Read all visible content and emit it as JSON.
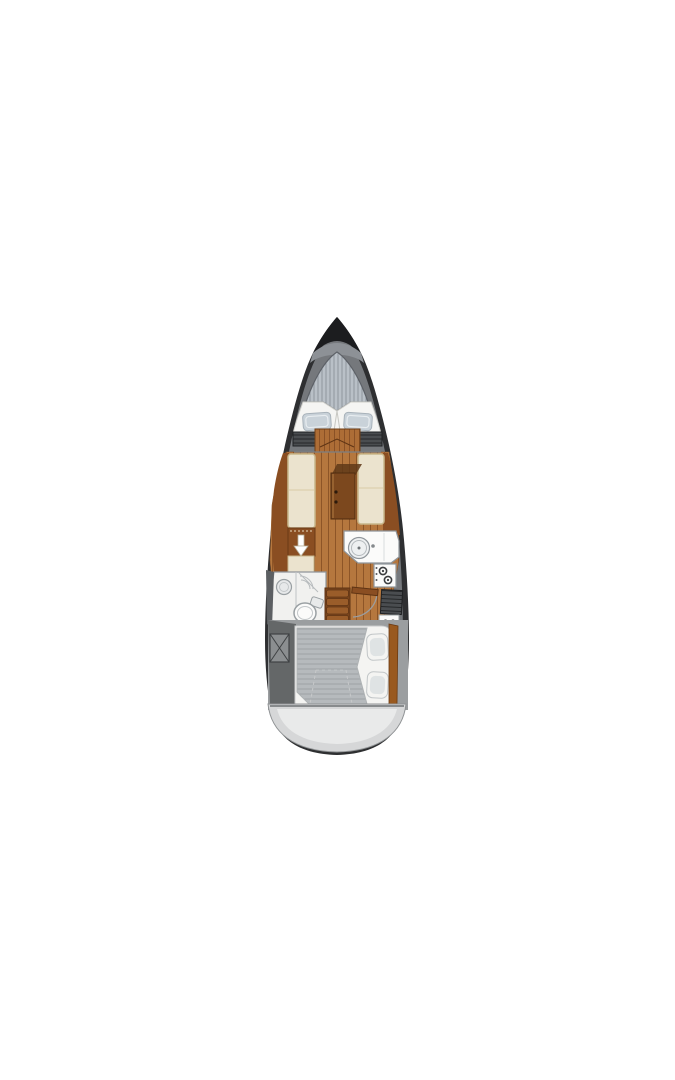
{
  "figure": {
    "type": "boat-floorplan",
    "view": "top-down",
    "orientation": "bow-up"
  },
  "parts": [
    "bow-tip",
    "anchor-locker-deck",
    "v-berth-mattress",
    "v-berth-pillows",
    "side-storage-lockers",
    "forward-berth-foot",
    "salon-wood-floor",
    "port-settee",
    "starboard-settee",
    "salon-table",
    "storage-cabinet-with-arrow",
    "galley-counter",
    "galley-sink",
    "galley-stove",
    "galley-locker",
    "head-compartment",
    "head-sink",
    "head-toilet",
    "shower",
    "companionway-steps",
    "aft-cabin-door",
    "aft-berth",
    "aft-berth-pillows",
    "cockpit-locker",
    "stern-transom"
  ],
  "colors": {
    "background": "#ffffff",
    "hull_dark": "#2e2f31",
    "hull_tip": "#1c1d1f",
    "hull_inner": "#75787c",
    "bow_band": "#8d9196",
    "deck_hatch_bg": "#b9c0c7",
    "deck_hatch_line": "#8f969e",
    "mattress_white": "#f5f5f3",
    "mattress_edge": "#cfcfca",
    "pillow_blue": "#c9d2d9",
    "pillow_edge": "#a8b2ba",
    "locker_dark": "#4a4d50",
    "locker_slat": "#26282a",
    "fore_bed_bg": "#ad6d36",
    "fore_bed_line": "#8a5126",
    "wood_floor": "#b5773e",
    "wood_floor_line": "#8d5527",
    "trim_brown": "#8a4e22",
    "settee_cream": "#ebe3ce",
    "settee_border": "#c8b78c",
    "table_brown": "#7c481e",
    "table_shadow": "#5f3817",
    "cabinet_brown": "#8a4e22",
    "arrow_white": "#ffffff",
    "galley_white": "#fbfbfa",
    "galley_edge": "#8f959a",
    "burner_dark": "#3b3d3f",
    "bath_white": "#f1f1ef",
    "fixture_gray": "#9aa0a3",
    "steps_brown": "#9a5d2a",
    "steps_dark": "#5f3414",
    "steps_base": "#7a451c",
    "door_arc": "#9b9ea1",
    "aft_surround": "#9b9ea0",
    "aft_dark": "#646768",
    "bed_frame_white": "#f4f4f2",
    "bed_stripe_bg": "#b6babd",
    "bed_stripe_line": "#9ea2a5",
    "stripe_right_brown": "#99591f",
    "stern_gray": "#d6d7d8",
    "stern_inner": "#e9eaea",
    "floor_gray": "#c9cbcd",
    "dark_side": "#5c5f62"
  }
}
